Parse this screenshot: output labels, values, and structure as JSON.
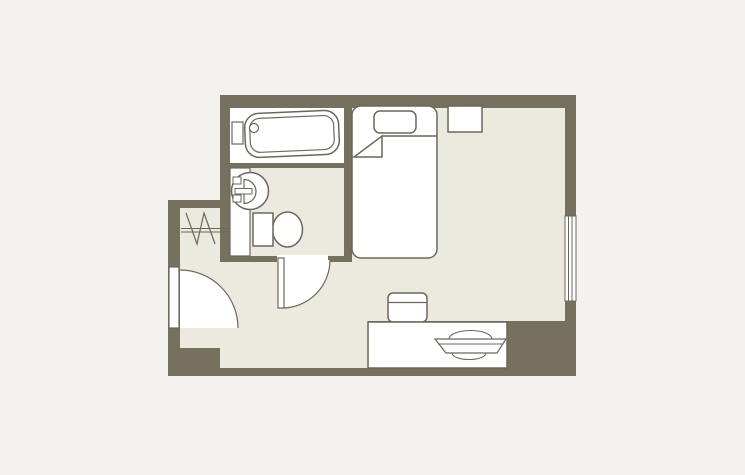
{
  "colors": {
    "background": "#f3f2ef",
    "wall": "#76705f",
    "floor": "#eceadf",
    "fixture_fill": "#ffffff",
    "outline": "#6b675c"
  },
  "floorplan": {
    "type": "hotel-room-floor-plan",
    "rooms": [
      {
        "name": "bathroom",
        "fixtures": [
          "bathtub",
          "bathtub-faucet",
          "bathtub-drain",
          "vanity-counter",
          "washbasin",
          "toilet",
          "bathroom-door"
        ]
      },
      {
        "name": "entry",
        "fixtures": [
          "entry-door",
          "closet-hanger-rail",
          "hangers-zigzag"
        ]
      },
      {
        "name": "bedroom",
        "fixtures": [
          "single-bed",
          "pillow",
          "blanket-fold",
          "wall-shelf",
          "window",
          "desk",
          "chair",
          "tv"
        ]
      }
    ]
  }
}
